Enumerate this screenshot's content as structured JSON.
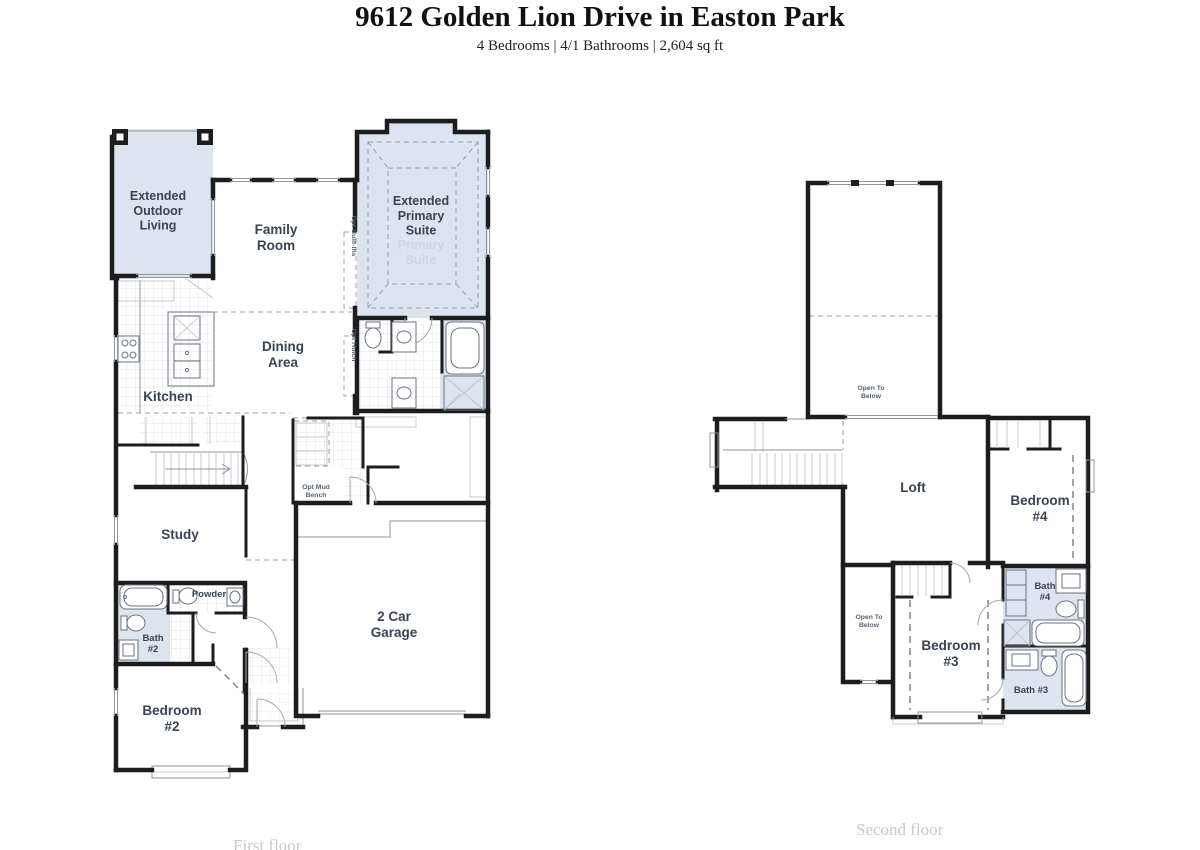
{
  "header": {
    "title": "9612 Golden Lion Drive in Easton Park",
    "subtitle": "4 Bedrooms | 4/1 Bathrooms | 2,604 sq ft"
  },
  "floors": {
    "first": {
      "caption": "First floor",
      "rooms": {
        "outdoor": [
          "Extended",
          "Outdoor",
          "Living"
        ],
        "family": [
          "Family",
          "Room"
        ],
        "suite": [
          "Extended",
          "Primary",
          "Suite"
        ],
        "suite_ghost": [
          "Primary",
          "Suite"
        ],
        "kitchen": "Kitchen",
        "dining": [
          "Dining",
          "Area"
        ],
        "study": "Study",
        "powder": "Powder",
        "bath2": [
          "Bath",
          "#2"
        ],
        "bedroom2": [
          "Bedroom",
          "#2"
        ],
        "garage": [
          "2 Car",
          "Garage"
        ],
        "mud_bench": [
          "Opt Mud",
          "Bench"
        ],
        "built_ins": "Opt Built-Ins",
        "hutch": "Opt Hutch"
      }
    },
    "second": {
      "caption": "Second floor",
      "rooms": {
        "open_below_large": [
          "Open To",
          "Below"
        ],
        "loft": "Loft",
        "bedroom4": [
          "Bedroom",
          "#4"
        ],
        "bath4": [
          "Bath",
          "#4"
        ],
        "open_below_small": [
          "Open To",
          "Below"
        ],
        "bedroom3": [
          "Bedroom",
          "#3"
        ],
        "bath3": "Bath #3"
      }
    }
  },
  "colors": {
    "highlight_fill": "#dde4ef",
    "wall": "#1d1d1d",
    "label_text": "#3b4350",
    "ghost_text": "#cdd5e2",
    "caption_text": "#c9c9c9"
  }
}
